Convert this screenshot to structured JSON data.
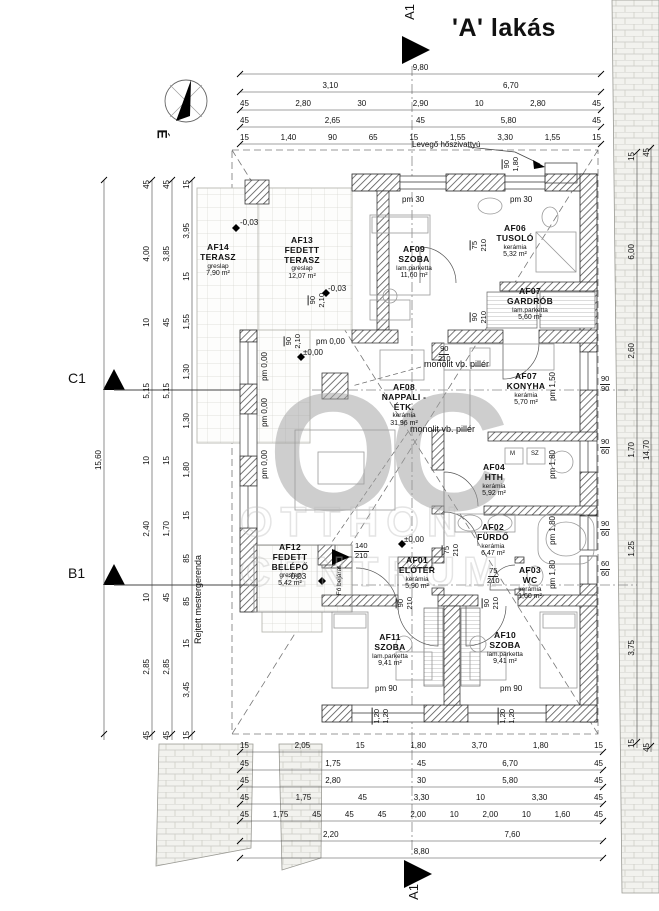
{
  "title": "'A' lakás",
  "markers": {
    "a1_top": "A1",
    "a1_bottom": "A1",
    "c1": "C1",
    "b1": "B1",
    "north": "É"
  },
  "watermark": {
    "logo": "OC",
    "line1": "OTTHON",
    "line2": "CENTRUM"
  },
  "rooms": [
    {
      "id": "AF14",
      "name": "TERASZ",
      "floor": "greslap",
      "area": "7,90 m²"
    },
    {
      "id": "AF13",
      "name": "FEDETT TERASZ",
      "floor": "greslap",
      "area": "12,07 m²"
    },
    {
      "id": "AF09",
      "name": "SZOBA",
      "floor": "lam.parketta",
      "area": "11,60 m²"
    },
    {
      "id": "AF06",
      "name": "TUSOLÓ",
      "floor": "kerámia",
      "area": "5,32 m²"
    },
    {
      "id": "AF07",
      "name": "GARDRÓB",
      "floor": "lam.parketta",
      "area": "5,60 m²"
    },
    {
      "id": "AF08",
      "name": "NAPPALI - ÉTK.",
      "floor": "kerámia",
      "area": "31,96 m²"
    },
    {
      "id": "AF07",
      "name": "KONYHA",
      "floor": "kerámia",
      "area": "5,70 m²"
    },
    {
      "id": "AF04",
      "name": "HTH",
      "floor": "kerámia",
      "area": "5,92 m²"
    },
    {
      "id": "AF02",
      "name": "FÜRDŐ",
      "floor": "kerámia",
      "area": "6,47 m²"
    },
    {
      "id": "AF03",
      "name": "WC",
      "floor": "kerámia",
      "area": "1,60 m²"
    },
    {
      "id": "AF01",
      "name": "ELŐTÉR",
      "floor": "kerámia",
      "area": "5,90 m²"
    },
    {
      "id": "AF12",
      "name": "FEDETT BELÉPŐ",
      "floor": "greslap",
      "area": "5,42 m²"
    },
    {
      "id": "AF11",
      "name": "SZOBA",
      "floor": "lam.parketta",
      "area": "9,41 m²"
    },
    {
      "id": "AF10",
      "name": "SZOBA",
      "floor": "lam.parketta",
      "area": "9,41 m²"
    }
  ],
  "annotations": {
    "heat_pump": "Levegő hőszivattyú",
    "pillar1": "monolit vb. pillér",
    "pillar2": "monolit vb. pillér",
    "hidden_beam": "Rejtett mestergerenda",
    "main_entrance": "Fő bejárat",
    "level_zero_a": "±0,00",
    "level_zero_b": "±0,00",
    "level_neg_a": "-0,03",
    "level_neg_b": "-0,03",
    "level_neg_c": "-0,03",
    "pm000_a": "pm 0,00",
    "pm000_b": "pm 0,00",
    "pm000_c": "pm 0,00",
    "pm000_d": "pm 0,00",
    "pm30_a": "pm 30",
    "pm30_b": "pm 30",
    "pm90_a": "pm 90",
    "pm90_b": "pm 90",
    "pm150": "pm 1,50",
    "pm180_a": "pm 1,80",
    "pm180_b": "pm 1,80",
    "pm180_c": "pm 1,80",
    "m_label": "M",
    "sz_label": "SZ"
  },
  "dims": {
    "top": [
      [
        "9,80"
      ],
      [
        "3,10",
        "6,70"
      ],
      [
        "45",
        "2,80",
        "30",
        "2,90",
        "10",
        "2,80",
        "45"
      ],
      [
        "45",
        "2,65",
        "45",
        "5,80",
        "45"
      ],
      [
        "15",
        "1,40",
        "90",
        "65",
        "15",
        "1,55",
        "3,30",
        "1,55",
        "15"
      ]
    ],
    "bottom": [
      [
        "15",
        "2,05",
        "15",
        "1,80",
        "3,70",
        "1,80",
        "15"
      ],
      [
        "45",
        "1,75",
        "45",
        "6,70",
        "45"
      ],
      [
        "45",
        "2,80",
        "30",
        "5,80",
        "45"
      ],
      [
        "45",
        "1,75",
        "45",
        "3,30",
        "10",
        "3,30",
        "45"
      ],
      [
        "45",
        "1,75",
        "45",
        "45",
        "45",
        "2,00",
        "10",
        "2,00",
        "10",
        "1,60",
        "45"
      ],
      [
        "2,20",
        "7,60"
      ],
      [
        "8,80"
      ]
    ],
    "left": [
      [
        "15,60"
      ],
      [
        "45",
        "4,00",
        "10",
        "5,15",
        "10",
        "2,40",
        "10",
        "2,85",
        "45"
      ],
      [
        "45",
        "3,85",
        "45",
        "5,15",
        "15",
        "1,70",
        "45",
        "2,85",
        "45"
      ],
      [
        "15",
        "3,95",
        "15",
        "1,55",
        "1,30",
        "1,30",
        "1,80",
        "15",
        "85",
        "85",
        "15",
        "3,45",
        "15"
      ]
    ],
    "right": [
      [
        "15",
        "6,00",
        "2,60",
        "1,70",
        "1,25",
        "3,75",
        "15"
      ],
      [
        "45",
        "14,70",
        "45"
      ]
    ]
  },
  "openings": [
    [
      "90",
      "2,10"
    ],
    [
      "90",
      "2,10"
    ],
    [
      "90",
      "210"
    ],
    [
      "75",
      "210"
    ],
    [
      "90",
      "210"
    ],
    [
      "140",
      "210"
    ],
    [
      "75",
      "210"
    ],
    [
      "90",
      "210"
    ],
    [
      "90",
      "210"
    ],
    [
      "75",
      "210"
    ],
    [
      "90",
      "90"
    ],
    [
      "90",
      "60"
    ],
    [
      "90",
      "60"
    ],
    [
      "60",
      "60"
    ],
    [
      "1,20",
      "1,20"
    ],
    [
      "1,20",
      "1,20"
    ],
    [
      "90",
      "1,80"
    ]
  ]
}
